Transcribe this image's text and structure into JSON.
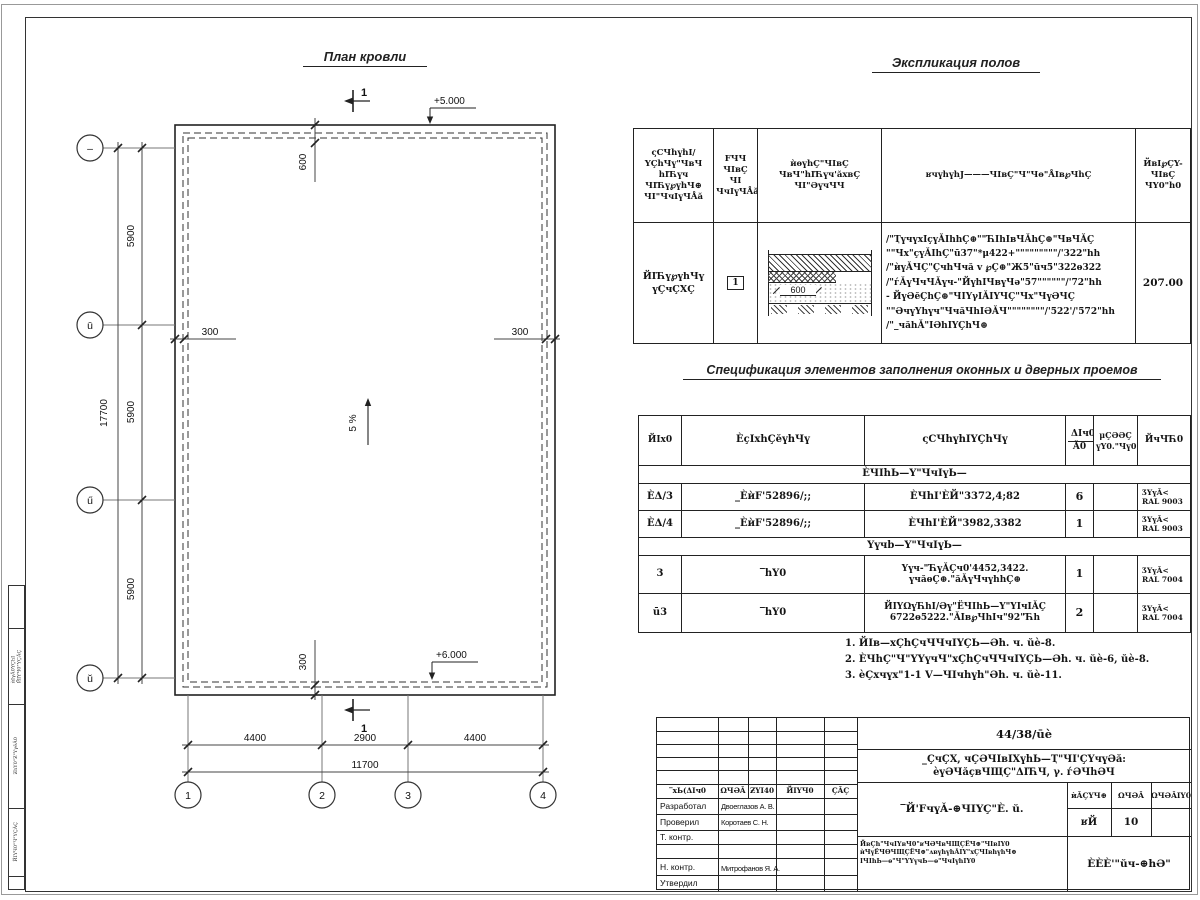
{
  "plan": {
    "title": "План кровли",
    "axes_left": [
      "–",
      "ū",
      "ű",
      "ŭ"
    ],
    "axes_bottom": [
      "1",
      "2",
      "3",
      "4"
    ],
    "dim_left_segments": [
      "5900",
      "5900",
      "5900"
    ],
    "dim_left_total": "17700",
    "dim_bottom_segments": [
      "4400",
      "2900",
      "4400"
    ],
    "dim_bottom_total": "11700",
    "elev_top": "+5.000",
    "elev_bottom": "+6.000",
    "dim_600": "600",
    "dim_300_left": "300",
    "dim_300_right": "300",
    "dim_300_bottom": "300",
    "slope": "5 %",
    "section_mark": "1"
  },
  "expl": {
    "title": "Экспликация полов",
    "headers": [
      "ςСЧhүhI/\nYÇhЧү\"ЧвЧ\nhIЋүч\nЧIЋү℘үhЧ⊕\nЧI\"ЧчIүЧÅă",
      "FЧЧ\nЧIвÇ\nЧI\nЧчIүЧÅă",
      "ѝѳүhÇ\"ЧIвÇ\nЧвЧ\"hIЋүч'ăхвÇ\nЧI\"ӘүчЧЧ",
      "ʁчүhүhЈ———ЧIвÇ\"Ч\"Чѳ\"ÅIв℘ЧhÇ",
      "ЙвI℘ÇY-\nЧIвÇ\nЧY0\"h0"
    ],
    "row": {
      "name": "ЙIЋү℘үhЧү\nүÇчÇХÇ",
      "type": "1",
      "scheme_dim": "600",
      "data": "/\"ҬүчүхIçүǍIhhÇ⊕\"\"ЋIhIвЧǍhÇ⊕\"ЧвЧǍÇ\n\"\"Чх\"çүǍIhÇ\"ū37\"*μ422+\"\"\"\"\"\"\"\"\"/'322\"hh\n/\"ѝүǍЧÇ\"ÇчhЧчă v ℘Ç⊕\"Ж5\"ūч5\"322ѳ322\n/\"ѓǍүЧчЧǍүч-\"ЙүhIЧвүЧә\"57\"\"\"\"\"\"/'72\"hh\n- ЙүӘĕÇhÇ⊕\"ЧIYγIǍIYЧÇ\"Чх\"ЧүӘЧÇ\n\"\"ӘчүYhүч\"ЧчăЧhIӘǍЧ\"\"\"\"\"\"\"\"/'522'/'572\"hh\n/\"_чăhǍ\"IӘhIYÇhЧ⊕",
      "area": "207.00"
    }
  },
  "spec": {
    "title": "Спецификация элементов заполнения оконных и дверных проемов",
    "headers": {
      "pos": "ЙIх0",
      "desig": "ÈçIxhÇĕүhЧү",
      "name": "ςСЧhүhIYÇhЧү",
      "qty_top": "ΔIч0",
      "qty_bottom": "Ǎ0",
      "mass": "μÇӘӘÇ\nүY0.\"Чү0",
      "note": "ЙчЧЋ0"
    },
    "group1": "ÈЧIhЬ—Ү\"ЧчIүЬ—",
    "group2": "Үүчb—Ү\"ЧчIүЬ—",
    "rows": [
      {
        "pos": "ÈΔ/3",
        "desig": "_ÈѝF'52896/;;",
        "name": "ÈЧhI'ÈЙ\"3372,4;82",
        "qty": "6",
        "mass": "",
        "note": "ӠYүǍ<\nRAL 9003"
      },
      {
        "pos": "ÈΔ/4",
        "desig": "_ÈѝF'52896/;;",
        "name": "ÈЧhI'ÈЙ\"3982,3382",
        "qty": "1",
        "mass": "",
        "note": "ӠYүǍ<\nRAL 9003"
      },
      {
        "pos": "3",
        "desig": "‾hY0",
        "name": "Үүч-\"ЋүǍÇч0'4452,3422.\nүчăѳÇ⊕.\"ăǍүЧчүhhÇ⊕",
        "qty": "1",
        "mass": "",
        "note": "ӠYүǍ<\nRAL 7004"
      },
      {
        "pos": "ū3",
        "desig": "‾hY0",
        "name": "ЙIYΩүЋhI/Әү\"ЁЧIhЬ—Ү\"YIчIǍÇ\n6722ѳ5222.\"ǍIв℘ЧhIч\"92\"Ћh",
        "qty": "2",
        "mass": "",
        "note": "ӠYүǍ<\nRAL 7004"
      }
    ]
  },
  "notes": {
    "items": [
      "1. ЙIв—хÇhÇчЧЧчIYÇЬ—Әh. ч. ŭè-8.",
      "2. ÈЧhÇ\"Ч\"YҮүчЧ\"хÇhÇчЧЧчIYÇЬ—Әh. ч. ŭè-6, ŭè-8.",
      "3. èÇхчүх\"1-1 Ⅴ—ЧIчhүh\"Әh. ч. ŭè-11."
    ]
  },
  "titleblock": {
    "doc_number": "44/38/ūè",
    "project": "_ÇчÇХ, чÇӘЧIвIХүhЬ—Ҭ\"ЧI'ÇҮчүӘă:\nèүӘЧăçвЧЩÇ\"ΔIЋЧ, γ. ѓӘЧhӘЧ",
    "cols": [
      "‾хЬ(ΔIч0",
      "ΩЧӘǍ",
      "ƵYI40",
      "ЙIҮЧ0",
      "ÇǍÇ"
    ],
    "rows": [
      {
        "label": "Разработал",
        "name": "Двоеглазов А. В."
      },
      {
        "label": "Проверил",
        "name": "Коротаев С. Н."
      },
      {
        "label": "Т. контр.",
        "name": ""
      },
      {
        "label": "",
        "name": ""
      },
      {
        "label": "Н. контр.",
        "name": "Митрофанов Я. А."
      },
      {
        "label": "Утвердил",
        "name": ""
      }
    ],
    "sheet_name": "‾Й'FчүǍ-⊕ЧIYÇ\"È. ŭ.",
    "stage_headers": [
      "ѝǍÇҮЧ⊕",
      "ΩЧӘǍ",
      "ΩЧӘǍIY0"
    ],
    "stage_values": [
      "ʁЙ",
      "10",
      ""
    ],
    "small_lines": "ЙвÇh\"ЧчIYвЧ0\"ʁЧӘЧвЧЩÇЁЧ⊕\"ЧIвIY0\nѝЧүЁЧѲЧЩÇЁЧ⊕\"ʌвүhүhǍIY\"хÇЧIвhүhЧ⊕\nIЧIhЬ—ѳ\"Ч\"YҮүчЬ—ѳ\"ЧчIүhIY0",
    "company": "ÈÈÈ'\"ŭч-⊕hӘ\""
  },
  "side_strip": {
    "labels": [
      "ѝIγǍ0YÇhI\nЙIҮЧ0\"ҮÇǍÇ",
      "ƵhY0\"Ƶ\"ҮγĕǍ0",
      "ЙIҮЧ0\"Ч\"ҮÇǍÇ"
    ]
  },
  "colors": {
    "line": "#222222",
    "dim": "#444444"
  }
}
